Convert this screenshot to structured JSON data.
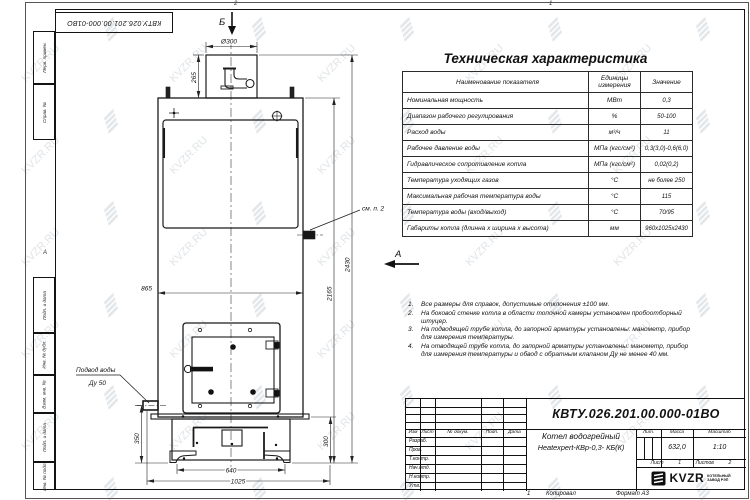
{
  "watermark": {
    "text": "KVZR.RU"
  },
  "sheet": {
    "top_stamp": "КВТУ.026.201.00.000-01ВО",
    "zone_top_1": "2",
    "zone_top_2": "1",
    "zone_left": "А",
    "left_strip": {
      "box1": "Перв. примен.",
      "box2": "Справ. №",
      "box3": "Подп. и дата",
      "box4": "Инв. № дубл.",
      "box5": "Взам. инв. №",
      "box6": "Подп. и дата",
      "box7": "Инв. № подл."
    },
    "bottom": {
      "zone": "1",
      "copied": "Копировал",
      "format": "Формат А3"
    }
  },
  "drawing": {
    "view_top": "Б",
    "view_side": "А",
    "callout": "см. п. 2",
    "water_inlet_line1": "Подвод воды",
    "water_inlet_line2": "Ду 50",
    "dims": {
      "chimney_dia": "Ø300",
      "chimney_h": "265",
      "body_width": "865",
      "total_height": "2430",
      "body_height": "2165",
      "inlet_height": "350",
      "base_height": "300",
      "base_inner_width": "640",
      "base_width": "1025"
    }
  },
  "spec": {
    "title": "Техническая характеристика",
    "col_name": "Наименование показателя",
    "col_units_1": "Единицы",
    "col_units_2": "измерения",
    "col_value": "Значение",
    "rows": [
      {
        "name": "Номинальная мощность",
        "units": "МВт",
        "value": "0,3"
      },
      {
        "name": "Диапазон рабочего регулирования",
        "units": "%",
        "value": "50-100"
      },
      {
        "name": "Расход воды",
        "units": "м³/ч",
        "value": "11"
      },
      {
        "name": "Рабочее давление воды",
        "units": "МПа (кгс/см²)",
        "value": "0,3(3,0)-0,6(6,0)"
      },
      {
        "name": "Гидравлическое сопротивление котла",
        "units": "МПа (кгс/см²)",
        "value": "0,02(0,2)"
      },
      {
        "name": "Температура уходящих газов",
        "units": "°С",
        "value": "не более 250"
      },
      {
        "name": "Максимальная рабочая температура воды",
        "units": "°С",
        "value": "115"
      },
      {
        "name": "Температура воды (вход/выход)",
        "units": "°С",
        "value": "70/95"
      },
      {
        "name": "Габариты котла (длинна х ширина х высота)",
        "units": "мм",
        "value": "960х1025х2430"
      }
    ]
  },
  "notes": {
    "items": [
      {
        "num": "1.",
        "text": "Все размеры для справок, допустимые отклонения ±100 мм."
      },
      {
        "num": "2.",
        "text": "На боковой стенке котла в области топочной камеры установлен пробоотборный штуцер."
      },
      {
        "num": "3.",
        "text": "На подводящей трубе котла, до запорной арматуры установлены: манометр, прибор для измерения температуры."
      },
      {
        "num": "4.",
        "text": "На отводящей трубе котла, до запорной арматуры установлены: манометр, прибор для измерения температуры и обвод с обратным клапаном Ду не менее 40 мм."
      }
    ]
  },
  "title_block": {
    "doc_number": "КВТУ.026.201.00.000-01ВО",
    "product_line1": "Котел водогрейный",
    "product_line2": "Heatexpert-КВр-0,3- КБ(К)",
    "col_izm": "Изм",
    "col_list": "Лист",
    "col_doc": "№ докум.",
    "col_sign": "Подп.",
    "col_date": "Дата",
    "row_labels": [
      "Разраб.",
      "Пров.",
      "Т.контр.",
      "Нач.отд.",
      "Н.контр.",
      "Утв."
    ],
    "lit_label": "Лит.",
    "mass_label": "Масса",
    "scale_label": "Масштаб",
    "mass_value": "632,0",
    "scale_value": "1:10",
    "sheet_label": "Лист",
    "sheet_value": "1",
    "sheets_label": "Листов",
    "sheets_value": "2",
    "brand": "KVZR",
    "brand_sub1": "КОТЕЛЬНЫЙ",
    "brand_sub2": "ЗАВОД РЭП"
  }
}
